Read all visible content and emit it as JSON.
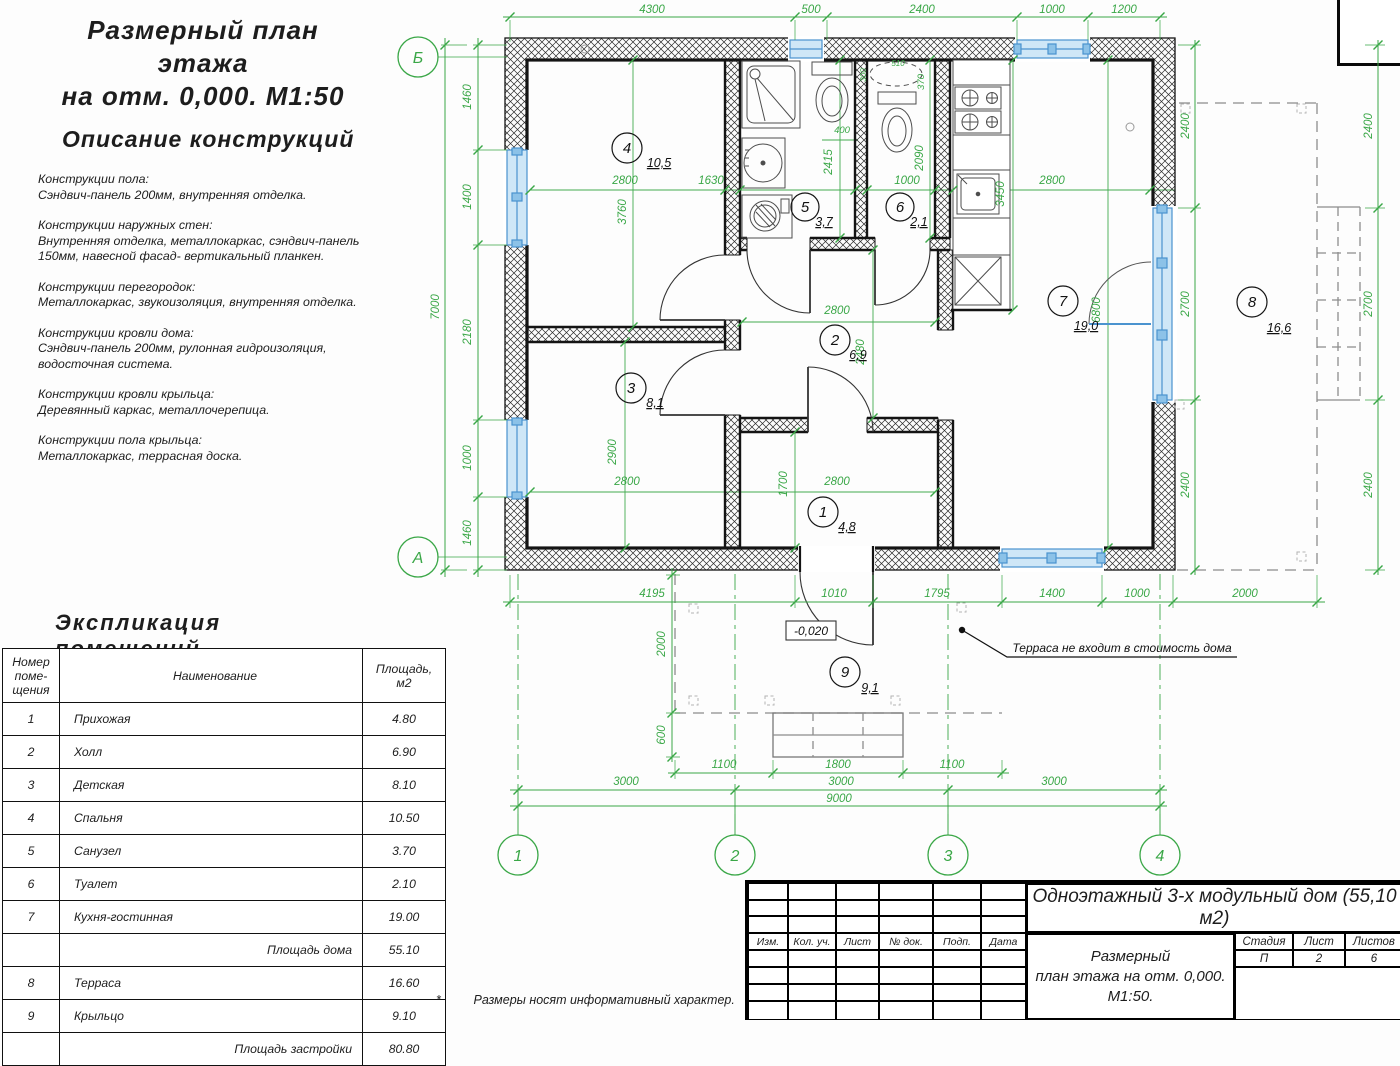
{
  "colors": {
    "green": "#3aa747",
    "blue": "#4a93cf",
    "blueFill": "#cfe7f7",
    "wall": "#141414",
    "gray": "#9a9a9a"
  },
  "page": {
    "title_line1": "Размерный план этажа",
    "title_line2": "на отм. 0,000. М1:50"
  },
  "description": {
    "heading": "Описание конструкций",
    "sections": [
      {
        "head": "Конструкции пола:",
        "body": "Сэндвич-панель 200мм, внутренняя отделка."
      },
      {
        "head": "Конструкции наружных стен:",
        "body": "Внутренняя отделка, металлокаркас, сэндвич-панель\n150мм, навесной фасад- вертикальный планкен."
      },
      {
        "head": "Конструкции перегородок:",
        "body": "Металлокаркас, звукоизоляция, внутренняя отделка."
      },
      {
        "head": "Конструкции кровли дома:",
        "body": "Сэндвич-панель 200мм, рулонная гидроизоляция,\nводосточная система."
      },
      {
        "head": "Конструкции кровли крыльца:",
        "body": "Деревянный каркас, металлочерепица."
      },
      {
        "head": "Конструкции пола крыльца:",
        "body": "Металлокаркас, террасная доска."
      }
    ]
  },
  "explication": {
    "heading": "Экспликация  помещений",
    "headers": [
      "Номер\nпоме-\nщения",
      "Наименование",
      "Площадь,\nм2"
    ],
    "rows": [
      {
        "num": "1",
        "name": "Прихожая",
        "area": "4.80"
      },
      {
        "num": "2",
        "name": "Холл",
        "area": "6.90"
      },
      {
        "num": "3",
        "name": "Детская",
        "area": "8.10"
      },
      {
        "num": "4",
        "name": "Спальня",
        "area": "10.50"
      },
      {
        "num": "5",
        "name": "Санузел",
        "area": "3.70"
      },
      {
        "num": "6",
        "name": "Туалет",
        "area": "2.10"
      },
      {
        "num": "7",
        "name": "Кухня-гостинная",
        "area": "19.00"
      },
      {
        "num": "",
        "name": "Площадь дома",
        "area": "55.10"
      },
      {
        "num": "8",
        "name": "Терраса",
        "area": "16.60"
      },
      {
        "num": "9",
        "name": "Крыльцо",
        "area": "9.10"
      },
      {
        "num": "",
        "name": "Площадь застройки",
        "area": "80.80"
      }
    ]
  },
  "plan": {
    "axes": {
      "cols": [
        "1",
        "2",
        "3",
        "4"
      ],
      "row_top": "Б",
      "row_bottom": "А"
    },
    "dims_top": [
      "4300",
      "500",
      "2400",
      "1000",
      "1200"
    ],
    "dims_left": [
      "1460",
      "1400",
      "2180",
      "1000",
      "1460"
    ],
    "dim_left_total": "7000",
    "dims_right": [
      "2400",
      "2700",
      "2400"
    ],
    "dims_bottom": [
      "4195",
      "1010",
      "1795",
      "1400",
      "1000",
      "2000"
    ],
    "dims_axes": [
      "3000",
      "3000",
      "3000"
    ],
    "dim_axes_total": "9000",
    "dims_porch_h": [
      "1100",
      "1800",
      "1100"
    ],
    "dims_porch_v": [
      "2000",
      "600"
    ],
    "interior": {
      "r1": [
        "2800",
        "1700"
      ],
      "r2": [
        "2800",
        "2480"
      ],
      "r3": [
        "2800",
        "2900"
      ],
      "r4": [
        "2800",
        "3760"
      ],
      "r5": [
        "1630",
        "2415",
        "400"
      ],
      "r6": [
        "1000",
        "2090",
        "370",
        "510",
        "300"
      ],
      "r7": [
        "2800",
        "3450",
        "6800"
      ]
    },
    "rooms": [
      {
        "num": "1",
        "area": "4,8"
      },
      {
        "num": "2",
        "area": "6,9"
      },
      {
        "num": "3",
        "area": "8,1"
      },
      {
        "num": "4",
        "area": "10,5"
      },
      {
        "num": "5",
        "area": "3,7"
      },
      {
        "num": "6",
        "area": "2,1"
      },
      {
        "num": "7",
        "area": "19,0"
      },
      {
        "num": "8",
        "area": "16,6"
      },
      {
        "num": "9",
        "area": "9,1"
      }
    ],
    "level": "-0,020",
    "note": "Терраса не входит в стоимость дома"
  },
  "footnote": {
    "star": "*",
    "text": "Размеры носят информативный характер."
  },
  "stamp": {
    "cols": [
      "Изм.",
      "Кол. уч.",
      "Лист",
      "№ док.",
      "Подп.",
      "Дата"
    ],
    "project": "Одноэтажный 3-х модульный дом (55,10 м2)",
    "doc": [
      "Размерный",
      "план этажа на отм. 0,000.",
      "М1:50."
    ],
    "meta": {
      "h": [
        "Стадия",
        "Лист",
        "Листов"
      ],
      "v": [
        "П",
        "2",
        "6"
      ]
    }
  }
}
